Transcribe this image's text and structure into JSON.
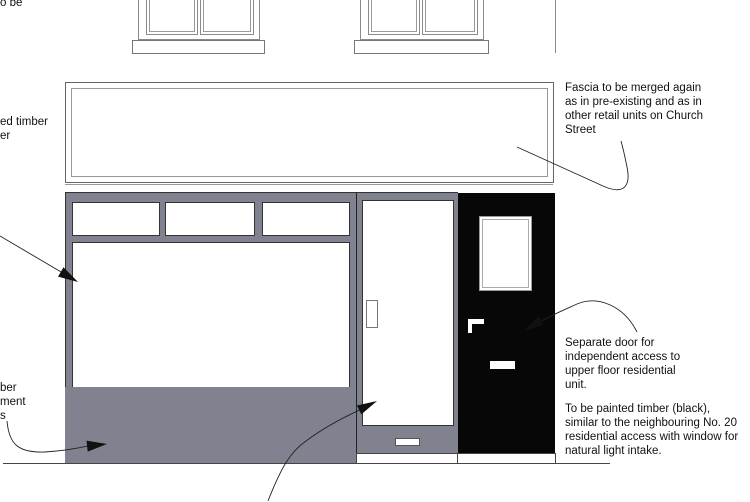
{
  "title": "Shopfront elevation drawing",
  "colors": {
    "frame-gray": "#80838f",
    "door-black": "#070707",
    "text": "#111111",
    "leader": "#222222"
  },
  "annotations": {
    "top_left_fragment": "o be",
    "left_upper_fragment": "ed timber\ner",
    "left_lower_fragment": "ber\nment\ns",
    "fascia_note": "Fascia to be merged again\nas in pre-existing and as in\nother retail units on Church\nStreet",
    "separate_door_note": "Separate door for\nindependent access to\nupper floor residential\nunit.",
    "painted_timber_note": "To be painted timber (black),\nsimilar to the neighbouring No. 20\nresidential access with window for\nnatural light intake."
  }
}
